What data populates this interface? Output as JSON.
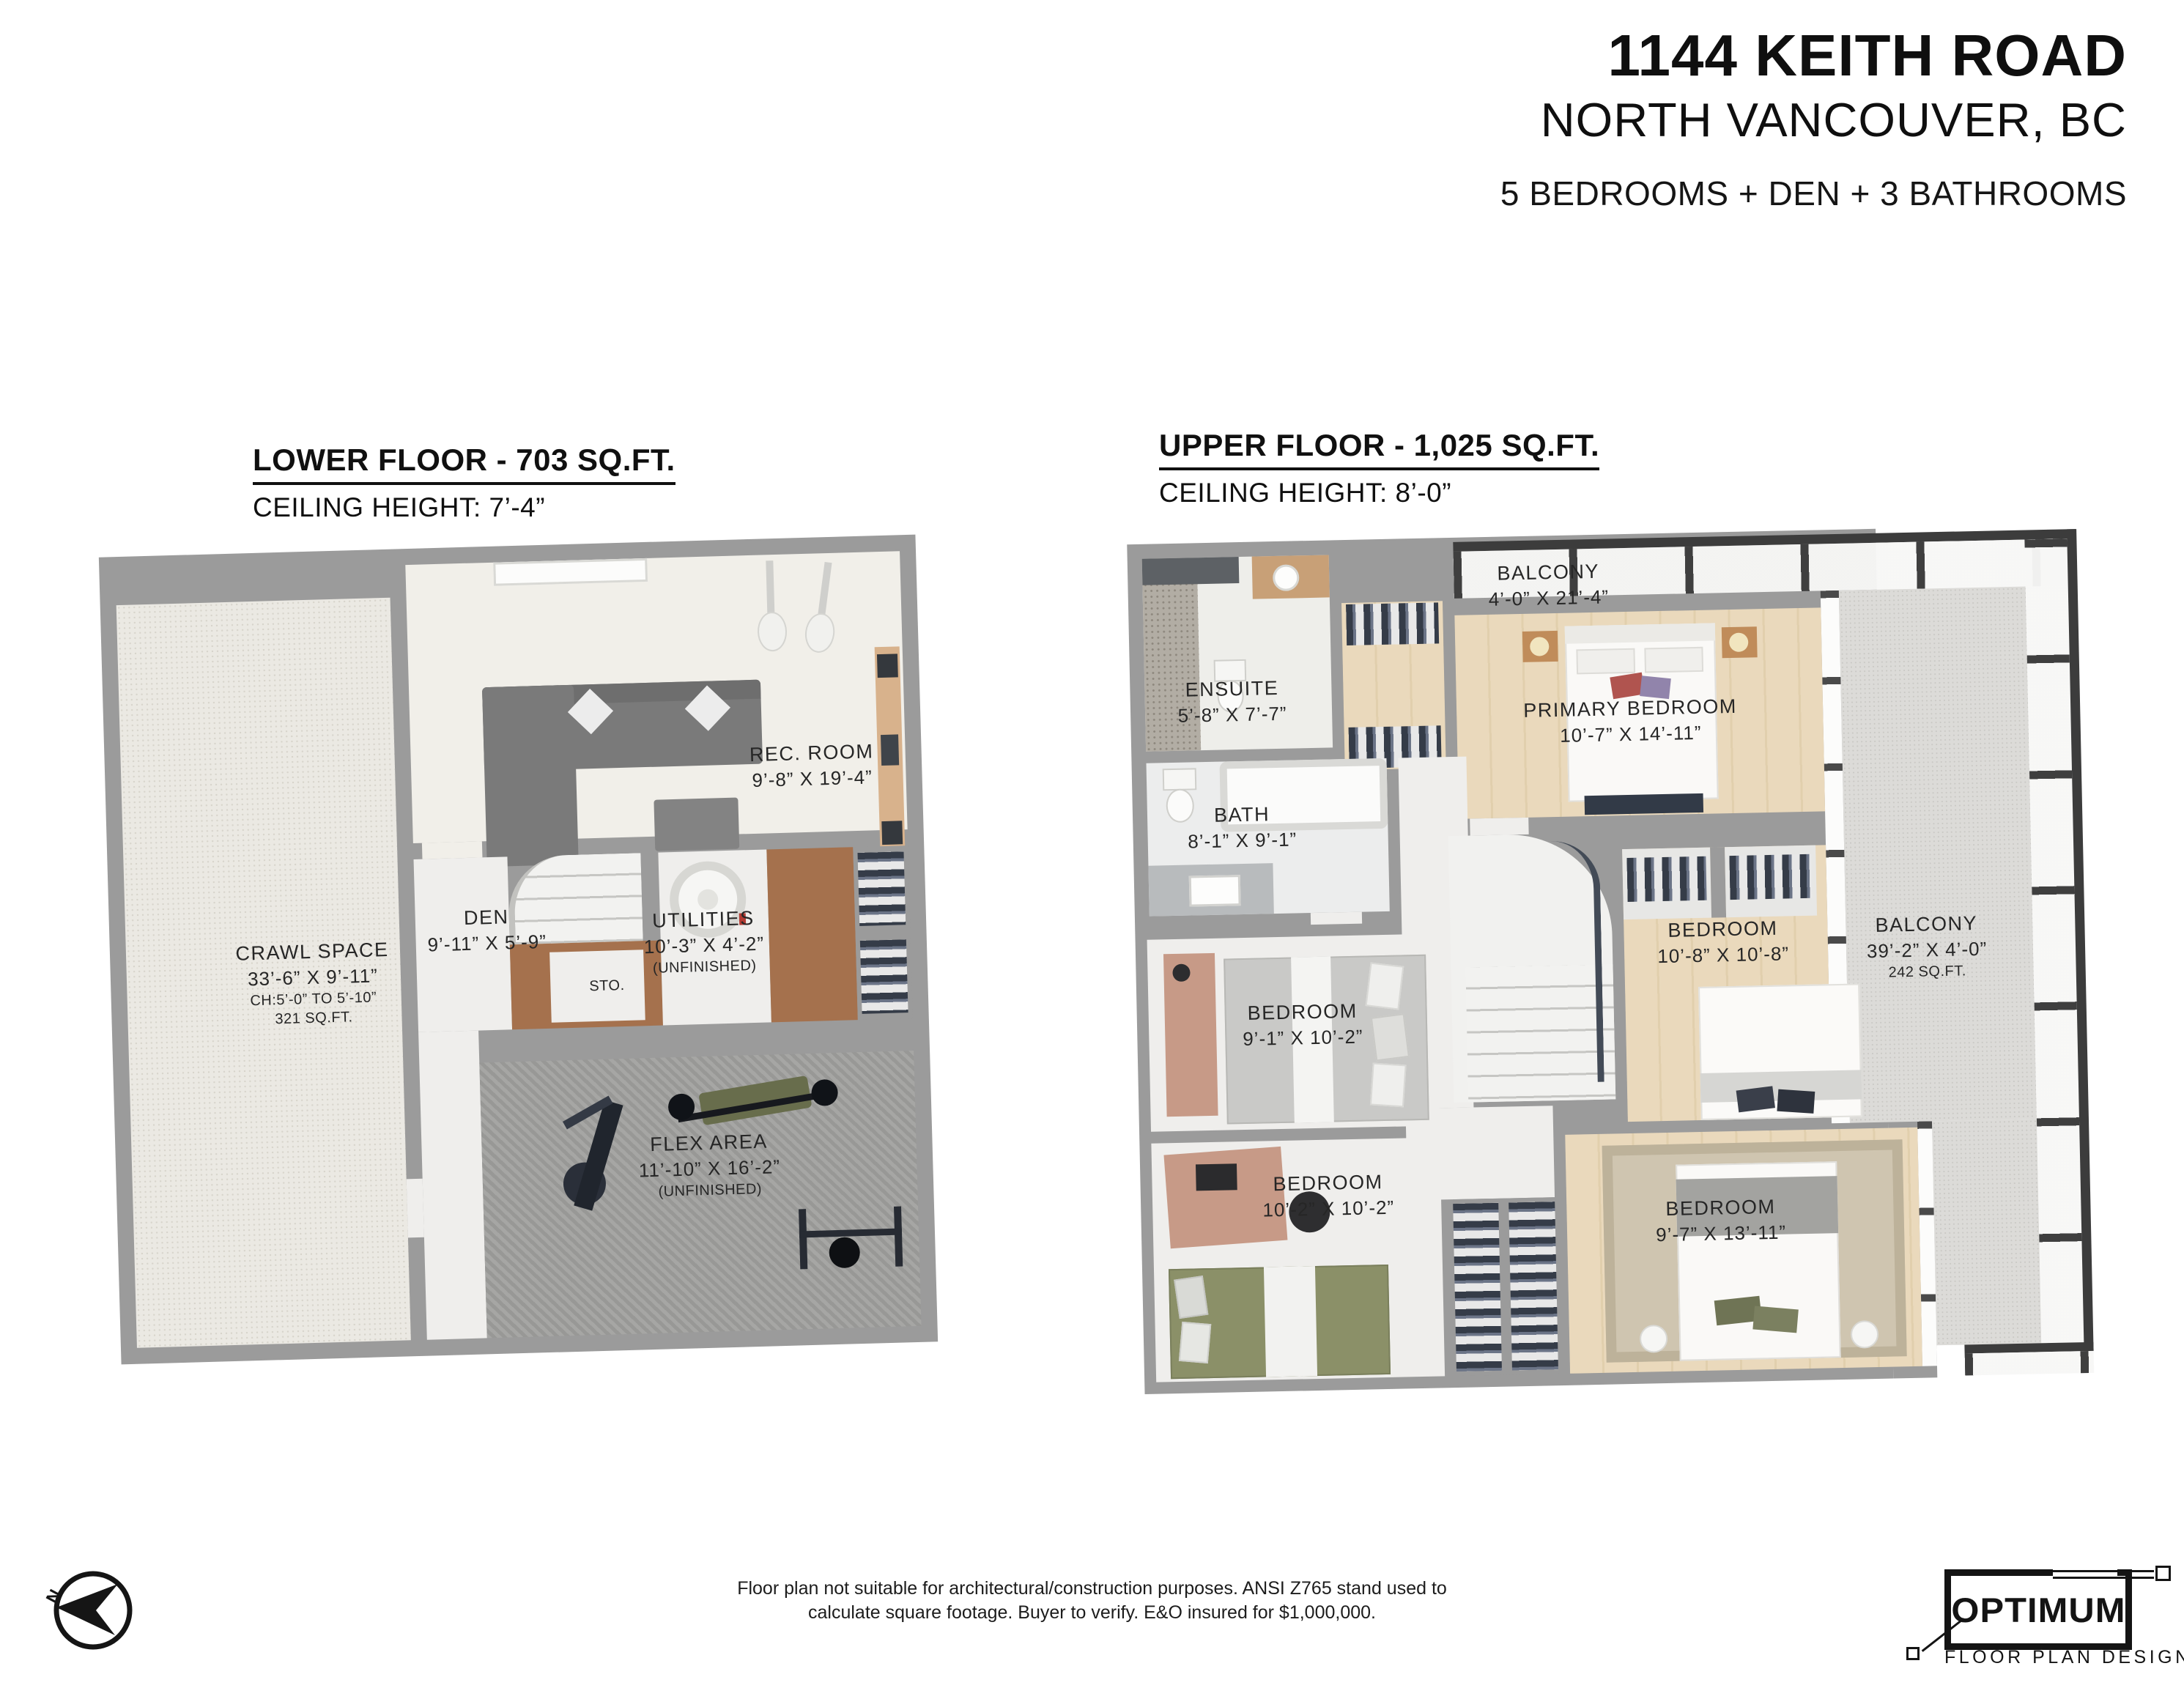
{
  "header": {
    "address": "1144 KEITH ROAD",
    "city": "NORTH VANCOUVER, BC",
    "summary": "5 BEDROOMS + DEN + 3 BATHROOMS"
  },
  "lower": {
    "title": "LOWER FLOOR - 703 SQ.FT.",
    "ceiling": "CEILING HEIGHT: 7’-4”",
    "rooms": {
      "rec": {
        "name": "REC. ROOM",
        "dims": "9’-8” X 19’-4”"
      },
      "den": {
        "name": "DEN",
        "dims": "9’-11” X 5’-9”"
      },
      "utilities": {
        "name": "UTILITIES",
        "dims": "10’-3” X 4’-2”",
        "note": "(UNFINISHED)"
      },
      "sto": {
        "name": "STO."
      },
      "crawl": {
        "name": "CRAWL SPACE",
        "dims": "33’-6” X 9’-11”",
        "note1": "CH:5’-0” TO 5’-10”",
        "note2": "321 SQ.FT."
      },
      "flex": {
        "name": "FLEX AREA",
        "dims": "11’-10” X 16’-2”",
        "note": "(UNFINISHED)"
      }
    }
  },
  "upper": {
    "title": "UPPER FLOOR - 1,025 SQ.FT.",
    "ceiling": "CEILING HEIGHT: 8’-0”",
    "rooms": {
      "balcony_top": {
        "name": "BALCONY",
        "dims": "4’-0” X 21’-4”"
      },
      "ensuite": {
        "name": "ENSUITE",
        "dims": "5’-8” X 7’-7”"
      },
      "primary": {
        "name": "PRIMARY BEDROOM",
        "dims": "10’-7” X 14’-11”"
      },
      "bath": {
        "name": "BATH",
        "dims": "8’-1” X 9’-1”"
      },
      "bedroom_mid": {
        "name": "BEDROOM",
        "dims": "10’-8” X 10’-8”"
      },
      "balcony_right": {
        "name": "BALCONY",
        "dims": "39’-2” X 4’-0”",
        "note": "242 SQ.FT."
      },
      "bedroom_left": {
        "name": "BEDROOM",
        "dims": "9’-1” X 10’-2”"
      },
      "bedroom_bl": {
        "name": "BEDROOM",
        "dims": "10’-2” X 10’-2”"
      },
      "bedroom_br": {
        "name": "BEDROOM",
        "dims": "9’-7” X 13’-11”"
      }
    }
  },
  "footer": {
    "disclaimer1": "Floor plan not suitable for architectural/construction purposes. ANSI Z765 stand used to",
    "disclaimer2": "calculate square footage. Buyer to verify.  E&O insured for $1,000,000.",
    "compass": "N",
    "logo_title": "OPTIMUM",
    "logo_subtitle": "FLOOR PLAN DESIGNS"
  },
  "colors": {
    "wall": "#9b9b9b",
    "wood_floor": "#e8d9bd",
    "carpet": "#9c9c9a",
    "subfloor_brown": "#a5714d",
    "railing": "#3c3c3c",
    "text": "#1a1a1a"
  }
}
